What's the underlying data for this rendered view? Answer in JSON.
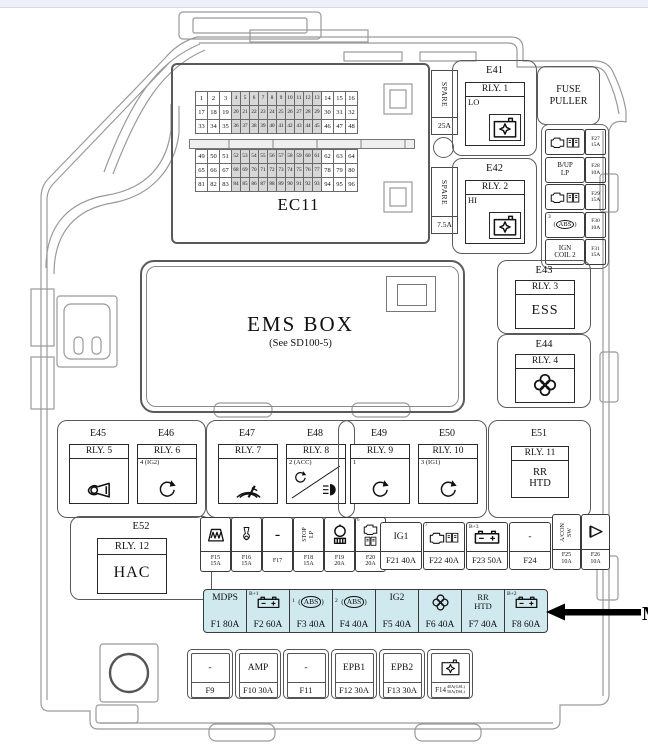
{
  "page": {
    "highlight_color": "#cfe9ee"
  },
  "ec11": {
    "label": "EC11",
    "rows": [
      [
        1,
        2,
        3,
        4,
        5,
        6,
        7,
        8,
        9,
        10,
        11,
        12,
        13,
        14,
        15,
        16
      ],
      [
        17,
        18,
        19,
        20,
        21,
        22,
        23,
        24,
        25,
        26,
        27,
        28,
        29,
        30,
        31,
        32
      ],
      [
        33,
        34,
        35,
        36,
        37,
        38,
        39,
        40,
        41,
        42,
        43,
        44,
        45,
        46,
        47,
        48
      ],
      [
        49,
        50,
        51,
        52,
        53,
        54,
        55,
        56,
        57,
        58,
        59,
        60,
        61,
        62,
        63,
        64
      ],
      [
        65,
        66,
        67,
        68,
        69,
        70,
        71,
        72,
        73,
        74,
        75,
        76,
        77,
        78,
        79,
        80
      ],
      [
        81,
        82,
        83,
        84,
        85,
        86,
        87,
        88,
        89,
        90,
        91,
        92,
        93,
        94,
        95,
        96
      ]
    ]
  },
  "spares": [
    {
      "label": "SPARE",
      "amp": "25A"
    },
    {
      "label": "SPARE",
      "amp": "7.5A"
    }
  ],
  "fuse_puller": {
    "text": "FUSE\nPULLER"
  },
  "relay_top": [
    {
      "id": "E41",
      "relay": "RLY. 1",
      "tag": "LO"
    },
    {
      "id": "E42",
      "relay": "RLY. 2",
      "tag": "HI"
    }
  ],
  "right_fuses": [
    {
      "type": "icons",
      "icons": [
        "engine",
        "ecu"
      ],
      "fuse": "F27",
      "amp": "15A"
    },
    {
      "type": "text",
      "label": "B/UP\nLP",
      "fuse": "F28",
      "amp": "10A"
    },
    {
      "type": "icons",
      "icons": [
        "engine",
        "ecu"
      ],
      "fuse": "F29",
      "amp": "15A"
    },
    {
      "type": "abs",
      "tag": "3",
      "fuse": "F30",
      "amp": "10A"
    },
    {
      "type": "text",
      "label": "IGN\nCOIL 2",
      "fuse": "F31",
      "amp": "15A"
    }
  ],
  "relay_right": [
    {
      "id": "E43",
      "relay": "RLY. 3",
      "label": "ESS"
    },
    {
      "id": "E44",
      "relay": "RLY. 4"
    }
  ],
  "ems": {
    "title": "EMS BOX",
    "subtitle": "(See SD100-5)"
  },
  "relay_row": [
    {
      "id": "E45",
      "relay": "RLY. 5",
      "icon": "horn"
    },
    {
      "id": "E46",
      "relay": "RLY. 6",
      "tag": "4 (IG2)",
      "icon": "rotate"
    },
    {
      "id": "E47",
      "relay": "RLY. 7",
      "icon": "wiper"
    },
    {
      "id": "E48",
      "relay": "RLY. 8",
      "tag": "2 (ACC)",
      "icon": "acchead"
    },
    {
      "id": "E49",
      "relay": "RLY. 9",
      "tag": "1",
      "icon": "rotate"
    },
    {
      "id": "E50",
      "relay": "RLY. 10",
      "tag": "3 (IG1)",
      "icon": "rotate"
    },
    {
      "id": "E51",
      "relay": "RLY. 11",
      "label": "RR\nHTD"
    }
  ],
  "e52": {
    "id": "E52",
    "relay": "RLY. 12",
    "label": "HAC"
  },
  "mid_fuses_small": [
    {
      "type": "icon",
      "icon": "glow",
      "fuse": "F15",
      "amp": "15A"
    },
    {
      "type": "icon",
      "icon": "horn2",
      "fuse": "F16",
      "amp": "15A"
    },
    {
      "type": "text",
      "label": "-",
      "fuse": "F17",
      "amp": ""
    },
    {
      "type": "vtext",
      "label": "STOP\nLP",
      "fuse": "F18",
      "amp": "15A"
    },
    {
      "type": "icon",
      "icon": "pump",
      "fuse": "F19",
      "amp": "20A"
    },
    {
      "type": "icons",
      "icons": [
        "engine",
        "ecu"
      ],
      "digit": "6",
      "fuse": "F20",
      "amp": "20A"
    }
  ],
  "mid_fuses_big": [
    {
      "type": "text",
      "label": "IG1",
      "fuse": "F21 40A"
    },
    {
      "type": "icons",
      "icons": [
        "engine",
        "ecu"
      ],
      "digit": "7",
      "fuse": "F22 40A"
    },
    {
      "type": "battery",
      "tag": "B+3",
      "fuse": "F23 50A"
    },
    {
      "type": "text",
      "label": "-",
      "fuse": "F24"
    }
  ],
  "acon_fuses": [
    {
      "type": "vtext",
      "label": "A/CON\nSW",
      "fuse": "F25",
      "amp": "10A"
    },
    {
      "type": "icon",
      "icon": "wedge",
      "fuse": "F26",
      "amp": "10A"
    }
  ],
  "highlight_row": [
    {
      "type": "text",
      "label": "MDPS",
      "fuse": "F1 80A"
    },
    {
      "type": "battery",
      "tag": "B+1",
      "fuse": "F2 60A"
    },
    {
      "type": "abs",
      "tag": "1",
      "fuse": "F3 40A"
    },
    {
      "type": "abs",
      "tag": "2",
      "fuse": "F4 40A"
    },
    {
      "type": "text",
      "label": "IG2",
      "fuse": "F5 40A"
    },
    {
      "type": "icon",
      "icon": "fan",
      "fuse": "F6 40A"
    },
    {
      "type": "text2",
      "label": "RR\nHTD",
      "fuse": "F7 40A"
    },
    {
      "type": "battery",
      "tag": "B+2",
      "fuse": "F8 60A"
    }
  ],
  "arrow": {
    "label": "M"
  },
  "bottom_row": [
    {
      "type": "text",
      "label": "-",
      "fuse": "F9"
    },
    {
      "type": "text",
      "label": "AMP",
      "fuse": "F10 30A"
    },
    {
      "type": "text",
      "label": "-",
      "fuse": "F11"
    },
    {
      "type": "text",
      "label": "EPB1",
      "fuse": "F12 30A"
    },
    {
      "type": "text",
      "label": "EPB2",
      "fuse": "F13 30A"
    },
    {
      "type": "icon",
      "icon": "relay",
      "fuse": "F14",
      "amps": [
        "40A(GSL)",
        "50A(DSL)"
      ]
    }
  ]
}
